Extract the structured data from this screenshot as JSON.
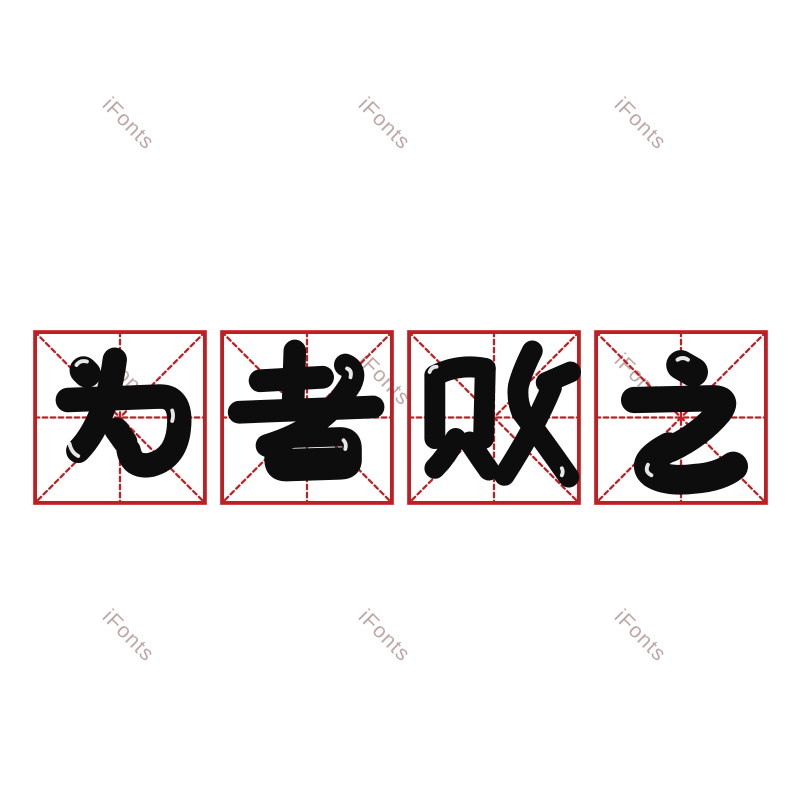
{
  "page": {
    "background": "#ffffff",
    "width_px": 800,
    "height_px": 800
  },
  "watermark": {
    "text": "iFonts",
    "color": "rgba(158,120,120,0.65)",
    "rotation_deg": 45,
    "font_size_px": 21,
    "centers": [
      {
        "x": 128,
        "y": 124
      },
      {
        "x": 384,
        "y": 124
      },
      {
        "x": 640,
        "y": 124
      },
      {
        "x": 128,
        "y": 380
      },
      {
        "x": 384,
        "y": 380
      },
      {
        "x": 640,
        "y": 380
      },
      {
        "x": 128,
        "y": 636
      },
      {
        "x": 384,
        "y": 636
      },
      {
        "x": 640,
        "y": 636
      }
    ]
  },
  "phrase": {
    "text": "为者败之",
    "glyph_color": "#0d0d0d",
    "characters": [
      {
        "char": "为",
        "name": "wei"
      },
      {
        "char": "者",
        "name": "zhe"
      },
      {
        "char": "败",
        "name": "bai"
      },
      {
        "char": "之",
        "name": "zhi"
      }
    ]
  },
  "practice_grid": {
    "style": "mi-zi-ge",
    "line_color": "#bf1f23",
    "cells": 4,
    "cell_width_px": 174,
    "cell_height_px": 175,
    "gap_px": 13,
    "left_px": 33,
    "top_px": 330
  }
}
